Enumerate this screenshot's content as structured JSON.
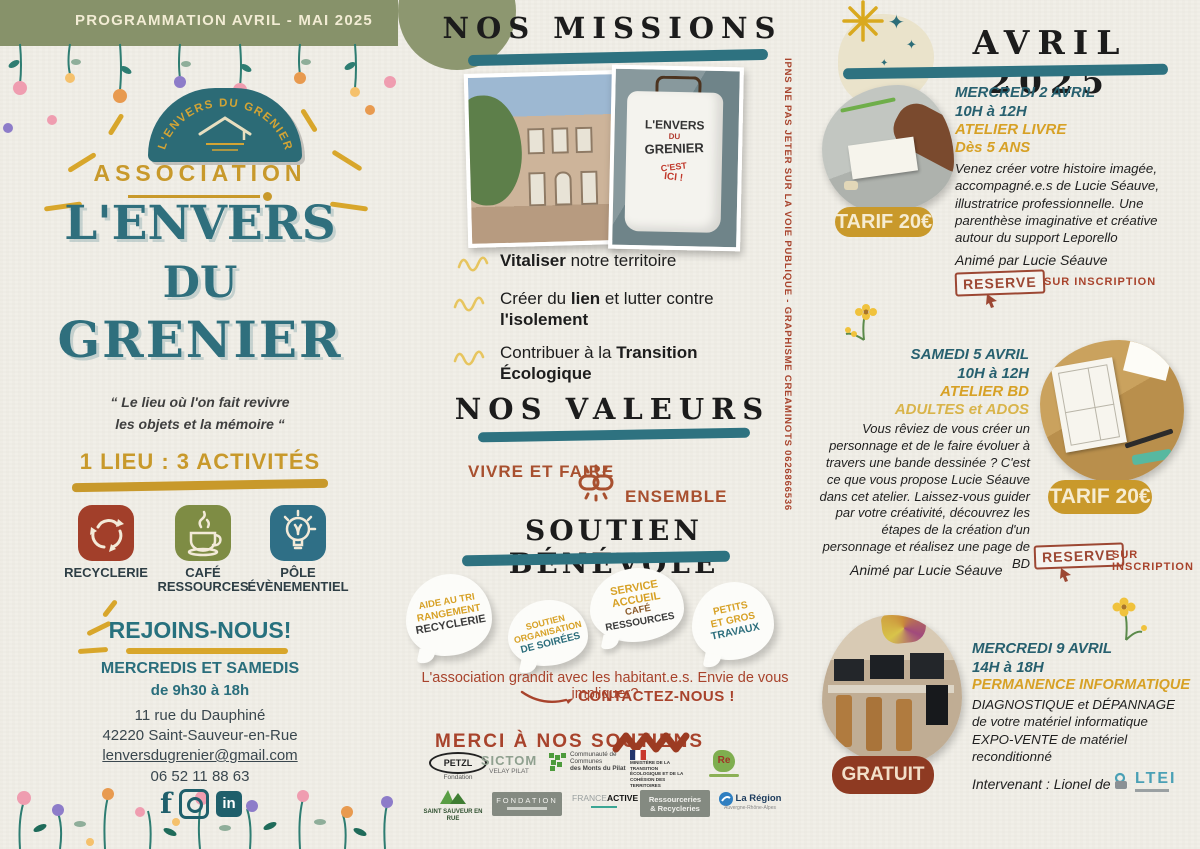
{
  "side_note": "IPNS NE PAS JETER SUR LA VOIE PUBLIQUE - GRAPHISME CREAMINOTS 0626866536",
  "left": {
    "banner": "PROGRAMMATION AVRIL - MAI 2025",
    "logo_arc_text": "L'ENVERS DU GRENIER",
    "association": "ASSOCIATION",
    "title1": "L'ENVERS",
    "title2": "DU",
    "title3": "GRENIER",
    "tagline": "“ Le lieu où l'on fait revivre\nles objets et la mémoire “",
    "activities_heading": "1 LIEU : 3 ACTIVITÉS",
    "activities": [
      {
        "label": "RECYCLERIE"
      },
      {
        "label": "CAFÉ\nRESSOURCES"
      },
      {
        "label": "PÔLE\nÉVÈNEMENTIEL"
      }
    ],
    "join_heading": "REJOINS-NOUS!",
    "join_days": "MERCREDIS ET SAMEDIS",
    "join_hours": "de 9h30 à 18h",
    "address_line1": "11 rue du Dauphiné",
    "address_line2": "42220 Saint-Sauveur-en-Rue",
    "email": "lenversdugrenier@gmail.com",
    "phone": "06 52 11 88 63"
  },
  "missions": {
    "heading": "NOS MISSIONS",
    "shirt": {
      "l1": "L'ENVERS",
      "l2": "DU",
      "l3": "GRENIER",
      "l4": "C'EST",
      "l5": "ICI !"
    },
    "items": [
      {
        "pre": "",
        "bold1": "Vitaliser",
        "mid": " notre territoire",
        "bold2": ""
      },
      {
        "pre": "Créer du ",
        "bold1": "lien",
        "mid": " et lutter contre ",
        "bold2": "l'isolement"
      },
      {
        "pre": "Contribuer à la ",
        "bold1": "Transition Écologique",
        "mid": "",
        "bold2": ""
      }
    ]
  },
  "values": {
    "heading": "NOS VALEURS",
    "phrase1": "VIVRE ET FAIRE",
    "phrase2": "ENSEMBLE"
  },
  "volunteer": {
    "heading": "SOUTIEN BÉNÉVOLE",
    "bubbles": [
      {
        "l1": "AIDE AU TRI",
        "l2": "RANGEMENT",
        "l3": "RECYCLERIE",
        "l4": ""
      },
      {
        "l1": "SOUTIEN",
        "l2": "ORGANISATION",
        "l3": "DE SOIRÉES",
        "l4": ""
      },
      {
        "l1": "SERVICE",
        "l2": "ACCUEIL",
        "l3": "CAFÉ",
        "l4": "RESSOURCES"
      },
      {
        "l1": "PETITS",
        "l2": "ET GROS",
        "l3": "TRAVAUX",
        "l4": ""
      }
    ],
    "cta_text": "L'association grandit avec les habitant.e.s. Envie de vous impliquer?",
    "cta_button": "CONTACTEZ-NOUS !"
  },
  "supporters": {
    "heading": "MERCI À NOS SOUTIENS",
    "logos": [
      {
        "name": "PETZL",
        "sub": "Fondation"
      },
      {
        "name": "SICTOM",
        "sub": "VELAY PILAT"
      },
      {
        "name": "Communauté de Communes",
        "sub": "des Monts du Pilat"
      },
      {
        "name": "MINISTÈRE DE LA TRANSITION ÉCOLOGIQUE ET DE LA COHÉSION DES TERRITOIRES",
        "sub": ""
      },
      {
        "name": "Re",
        "sub": ""
      },
      {
        "name": "SAINT SAUVEUR EN RUE",
        "sub": ""
      },
      {
        "name": "FONDATION",
        "sub": ""
      },
      {
        "name": "FRANCE ACTIVE",
        "sub": ""
      },
      {
        "name": "Ressourceries",
        "sub": "& Recycleries"
      },
      {
        "name": "La Région",
        "sub": "Auvergne-Rhône-Alpes"
      }
    ]
  },
  "calendar": {
    "heading": "AVRIL 2025",
    "events": [
      {
        "day": "MERCREDI 2 AVRIL",
        "time": "10H à 12H",
        "title": "ATELIER LIVRE",
        "audience": "Dès 5 ANS",
        "description": "Venez créer votre histoire imagée, accompagné.e.s de Lucie Séauve, illustratrice professionnelle. Une parenthèse imaginative et créative autour du support Leporello",
        "host": "Animé par Lucie Séauve",
        "price": "TARIF 20€",
        "reserve": "RESERVE",
        "inscription": "SUR INSCRIPTION"
      },
      {
        "day": "SAMEDI 5 AVRIL",
        "time": "10H à 12H",
        "title": "ATELIER BD",
        "audience": "ADULTES et ADOS",
        "description": "Vous rêviez de vous créer un personnage et de le faire évoluer à travers une bande dessinée ? C'est ce que vous propose Lucie Séauve dans cet atelier. Laissez-vous guider par votre créativité, découvrez les étapes de la création d'un personnage et réalisez une page de BD",
        "host": "Animé par Lucie Séauve",
        "price": "TARIF 20€",
        "reserve": "RESERVE",
        "inscription": "SUR INSCRIPTION"
      },
      {
        "day": "MERCREDI 9 AVRIL",
        "time": "14H à 18H",
        "title": "PERMANENCE INFORMATIQUE",
        "description": "DIAGNOSTIQUE et DÉPANNAGE\nde votre matériel informatique\nEXPO-VENTE de matériel\nreconditionné",
        "price": "GRATUIT",
        "intervenant": "Intervenant : Lionel de",
        "partner": "LTEI"
      }
    ]
  }
}
